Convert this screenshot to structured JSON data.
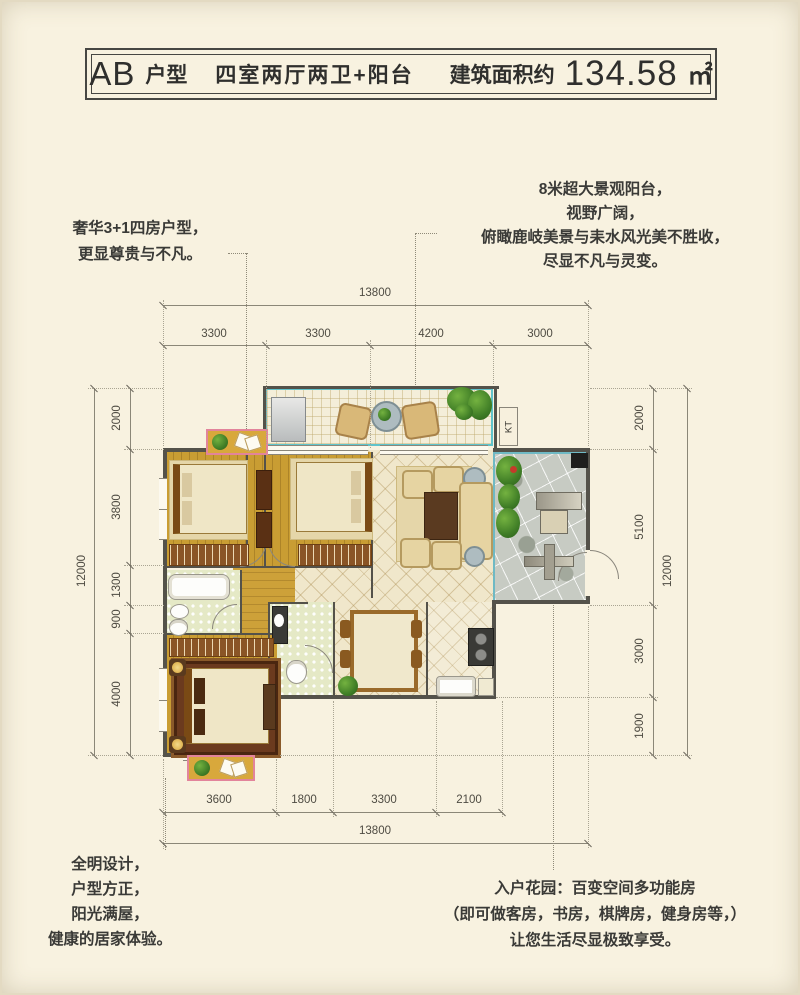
{
  "title": {
    "unit_prefix": "AB",
    "unit_suffix": "户型",
    "layout": "四室两厅两卫+阳台",
    "area_label": "建筑面积约",
    "area_value": "134.58",
    "area_unit": "㎡"
  },
  "annotations": {
    "top_left": {
      "lines": [
        "奢华3+1四房户型，",
        "更显尊贵与不凡。"
      ]
    },
    "top_right": {
      "lines": [
        "8米超大景观阳台，",
        "视野广阔，",
        "俯瞰鹿岐美景与耒水风光美不胜收，",
        "尽显不凡与灵变。"
      ]
    },
    "bottom_left": {
      "lines": [
        "全明设计，",
        "户型方正，",
        "阳光满屋，",
        "健康的居家体验。"
      ]
    },
    "bottom_right": {
      "lines": [
        "入户花园：百变空间多功能房",
        "（即可做客房，书房，棋牌房，健身房等，）",
        "让您生活尽显极致享受。"
      ]
    }
  },
  "dimensions": {
    "top": {
      "total": "13800",
      "segments": [
        "3300",
        "3300",
        "4200",
        "3000"
      ]
    },
    "bottom": {
      "total": "13800",
      "segments": [
        "3600",
        "1800",
        "3300",
        "2100"
      ]
    },
    "left": {
      "total": "12000",
      "segments": [
        "2000",
        "3800",
        "1300",
        "900",
        "4000"
      ]
    },
    "right": {
      "total": "12000",
      "segments": [
        "2000",
        "5100",
        "3000",
        "1900"
      ]
    }
  },
  "plan": {
    "kt_label": "KT"
  },
  "colors": {
    "background": "#f8f2e0",
    "balcony_border_teal": "#5fc3cb",
    "wood_floor": "#c99d33",
    "wall": "#54524a",
    "flower_box_pink": "#e2849b",
    "dimension_gray": "#8b8778",
    "text_dark": "#3a3a37"
  }
}
